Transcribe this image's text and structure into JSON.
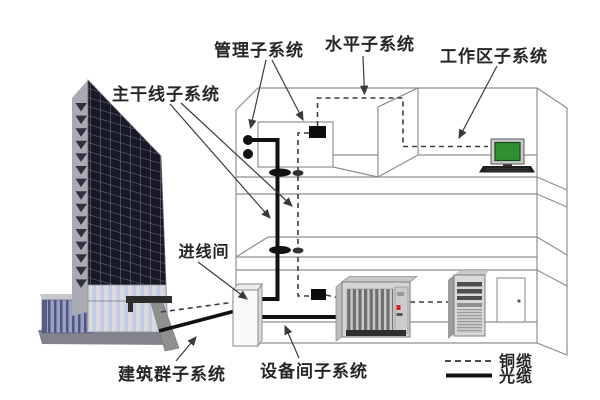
{
  "diagram": {
    "type": "structured-cabling-system",
    "labels": {
      "management_subsystem": "管理子系统",
      "horizontal_subsystem": "水平子系统",
      "work_area_subsystem": "工作区子系统",
      "backbone_subsystem": "主干线子系统",
      "entrance_room": "进线间",
      "campus_subsystem": "建筑群子系统",
      "equipment_room_subsystem": "设备间子系统"
    },
    "legend": {
      "copper_cable_label": "铜缆",
      "copper_cable_style": "dashed",
      "fiber_cable_label": "光缆",
      "fiber_cable_style": "solid"
    },
    "colors": {
      "copper_dashed": "#3d3d3d",
      "fiber_solid": "#111111",
      "outline_gray": "#8f8f8f",
      "label_text": "#262626",
      "screen_green": "#2f9030",
      "led_red": "#cc2222"
    }
  }
}
